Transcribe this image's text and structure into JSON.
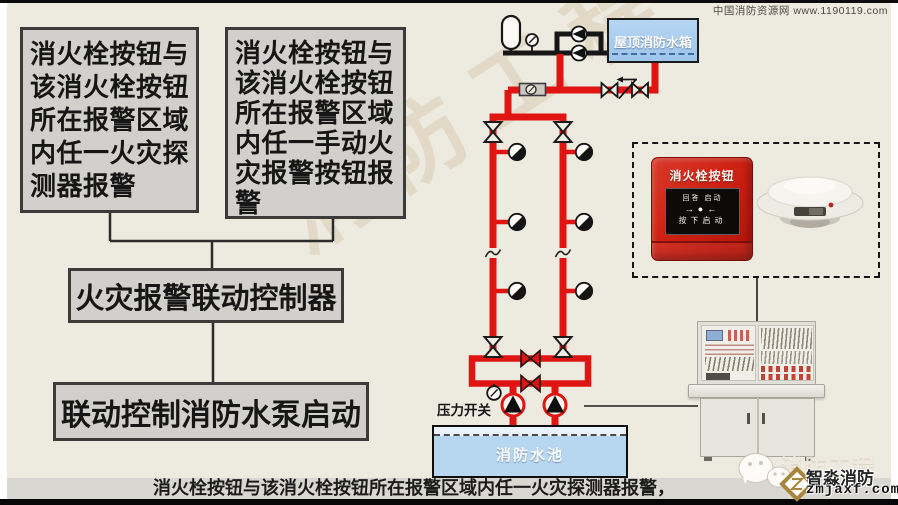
{
  "watermark_top": "中国消防资源网 www.1190119.com",
  "flowchart": {
    "condition1": "消火栓按钮与该消火栓按钮所在报警区域内任一火灾探测器报警",
    "condition2": "消火栓按钮与该消火栓按钮所在报警区域内任一手动火灾报警按钮报警",
    "controller": "火灾报警联动控制器",
    "action": "联动控制消防水泵启动"
  },
  "diagram": {
    "roof_tank_label": "屋顶消防水箱",
    "pressure_switch_label": "压力开关",
    "pool_label": "消防水池"
  },
  "equipment": {
    "hydrant_button": {
      "title": "消火栓按钮",
      "indicators": "回答 启动",
      "arrows": "→●←",
      "press_label": "按下启动"
    }
  },
  "caption": "消火栓按钮与该消火栓按钮所在报警区域内任一火灾探测器报警，",
  "branding": {
    "watermark": "消防工程",
    "name": "智淼消防",
    "site": "zmjaxf.com"
  },
  "colors": {
    "pipe_red": "#e01410",
    "line_black": "#161616",
    "tank_blue": "#abcdee",
    "pool_blue": "#b7d7f1",
    "box_gray": "#d2d0cc",
    "background": "#edeae0"
  }
}
